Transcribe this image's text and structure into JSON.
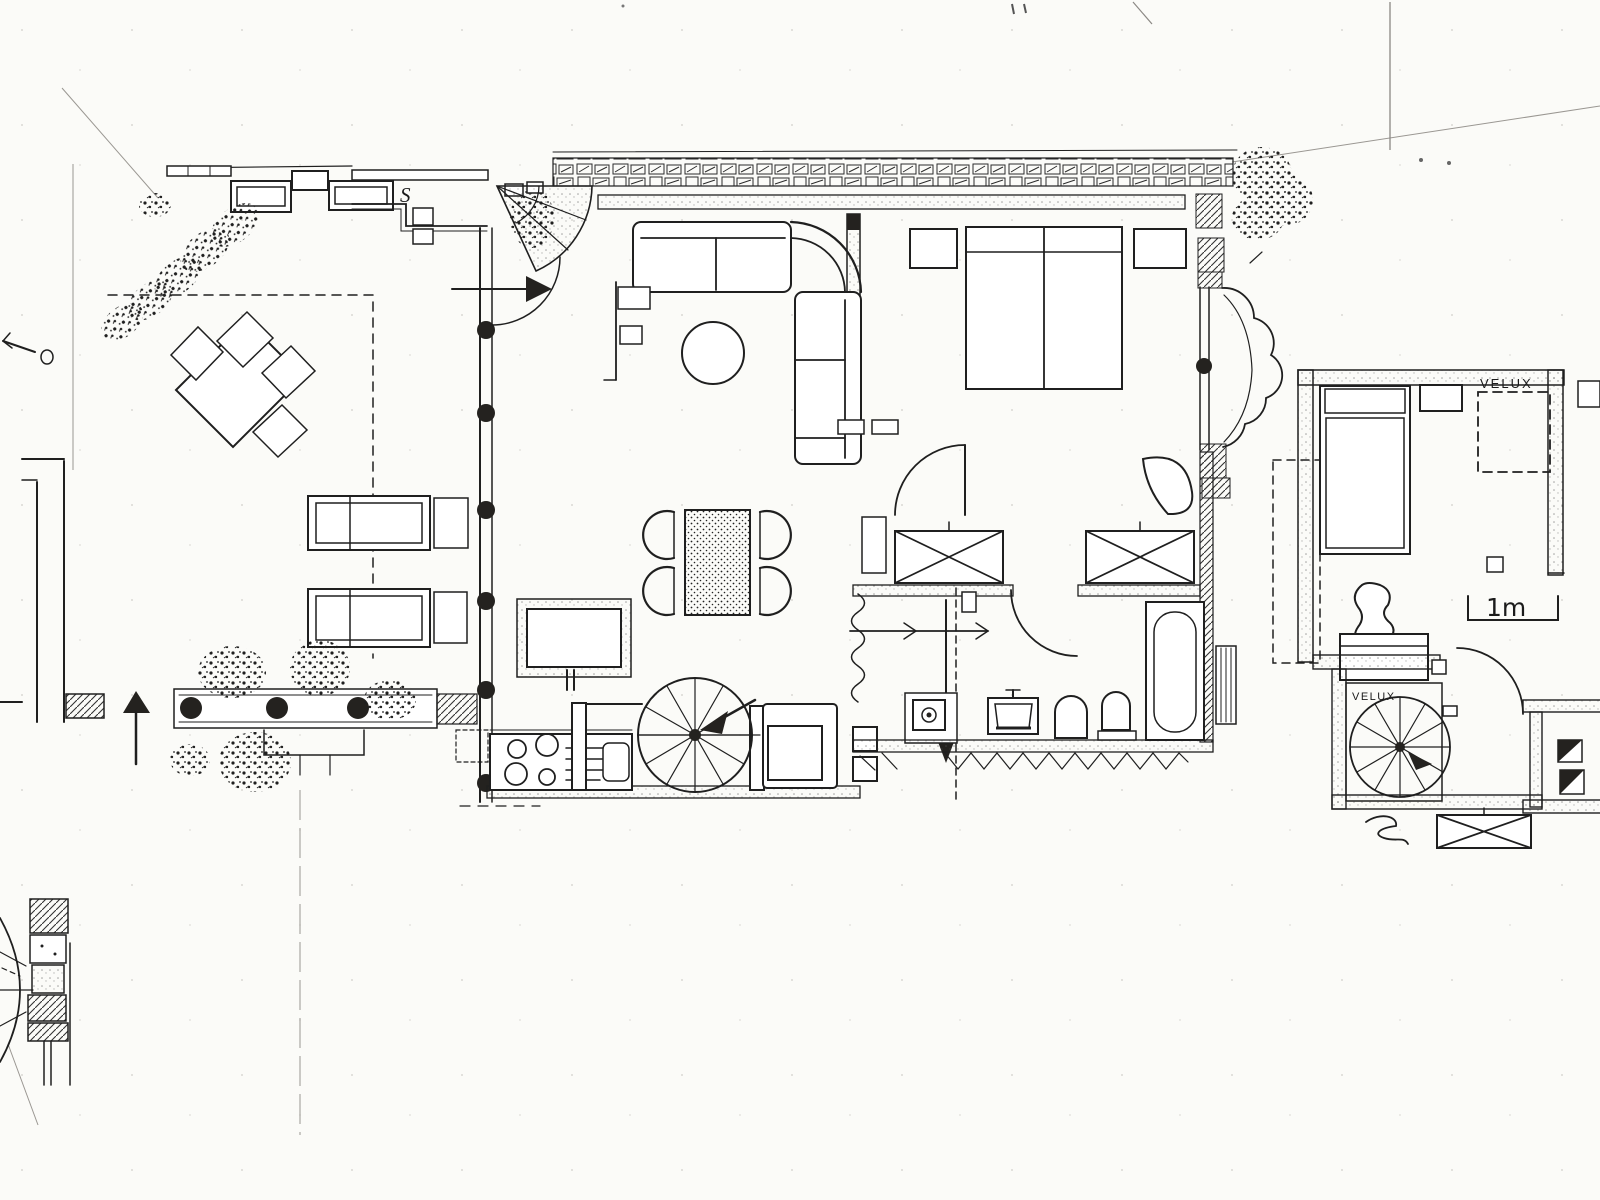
{
  "colors": {
    "paper": "#fbfbf8",
    "ink": "#1f1f1f",
    "ink_faint": "#9a9792"
  },
  "labels": {
    "velux_attic": "VELUX",
    "velux_stairwell": "VELUX",
    "scale_marker": "1m",
    "section_mark": "S"
  },
  "legend": {
    "ground_floor_rooms": [
      "terrace",
      "living-dining-room",
      "kitchen",
      "hallway",
      "bedroom",
      "bathroom"
    ],
    "attic_rooms": [
      "attic-bedroom",
      "stairwell",
      "attic-side-room"
    ],
    "features": [
      "spiral-staircase",
      "velux-skylights",
      "bay-window",
      "garden-furniture",
      "planter-boxes",
      "north-arrow",
      "1m-scale-bar"
    ]
  }
}
